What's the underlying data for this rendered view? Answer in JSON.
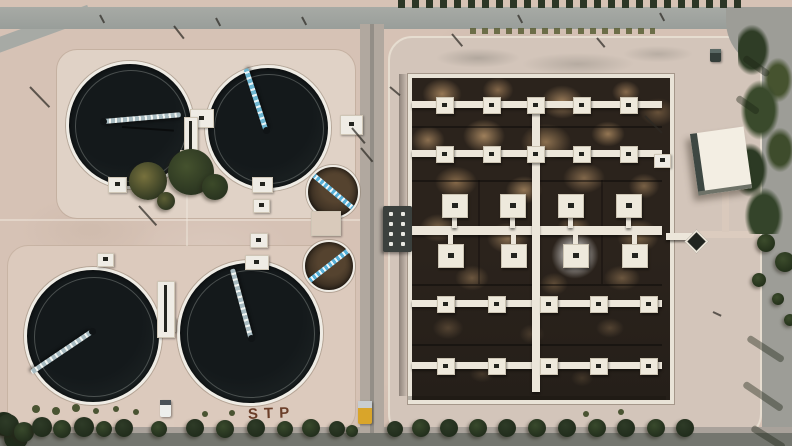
{
  "scene": {
    "title": "Aerial drone view of a sewage treatment plant",
    "ground_text": "STP",
    "description": "Top-down aerial photo: four large dark circular clarifier tanks with scraper bridges and two small circular tanks on sandy ground at left; a large rectangular aeration basin with white walkways and square aerator platforms over mottled brown water at right; roads, trees and a white flat-roof building around the site."
  },
  "palette": {
    "sand": "#d6c2b5",
    "pad_light": "#e0d2c6",
    "apron": "#d3c5ba",
    "road": "#9d9d97",
    "road_dark": "#74766f",
    "tank_water": "#14191b",
    "tank_rim": "#efece5",
    "bridge_blue": "#6fb7d2",
    "bridge_light": "#a9bcc2",
    "basin_dark": "#2b231c",
    "basin_tan": "#a5855f",
    "walkway": "#ece6da",
    "building_roof": "#f3eee3",
    "truck_yellow": "#d9a52a",
    "tree_shades": [
      "#2e3b27",
      "#394a2c",
      "#222e1c"
    ]
  },
  "clarifiers": [
    {
      "id": "clarifier-tank-nw",
      "cx": 127,
      "cy": 122,
      "r": 61,
      "bridge": {
        "x": 103,
        "y": 121,
        "len": 78,
        "angle": -5,
        "style": "light"
      }
    },
    {
      "id": "clarifier-tank-ne",
      "cx": 265,
      "cy": 125,
      "r": 60,
      "bridge": {
        "x": 266,
        "y": 130,
        "len": 65,
        "angle": -108,
        "style": "blue"
      }
    },
    {
      "id": "clarifier-tank-sw",
      "cx": 90,
      "cy": 333,
      "r": 66,
      "bridge": {
        "x": 92,
        "y": 331,
        "len": 73,
        "angle": 146,
        "style": "light"
      }
    },
    {
      "id": "clarifier-tank-se",
      "cx": 247,
      "cy": 330,
      "r": 70,
      "bridge": {
        "x": 251,
        "y": 338,
        "len": 72,
        "angle": -105,
        "style": "light"
      }
    }
  ],
  "small_tanks": [
    {
      "id": "small-tank-upper",
      "cx": 331,
      "cy": 190,
      "r": 25,
      "bridge_angle": 40
    },
    {
      "id": "small-tank-lower",
      "cx": 327,
      "cy": 264,
      "r": 24,
      "bridge_angle": -38
    }
  ],
  "basin": {
    "x": 408,
    "y": 74,
    "w": 258,
    "h": 322,
    "walkway_rows": [
      97,
      146,
      296,
      358
    ],
    "main_walkway_y": 222,
    "vertical_walkway_x": 528,
    "small_rows": [
      {
        "y": 97,
        "cols": [
          440,
          487,
          531,
          577,
          624
        ]
      },
      {
        "y": 146,
        "cols": [
          440,
          487,
          531,
          577,
          624
        ]
      },
      {
        "y": 296,
        "cols": [
          441,
          492,
          544,
          594,
          644
        ]
      },
      {
        "y": 358,
        "cols": [
          441,
          492,
          544,
          594,
          644
        ]
      }
    ],
    "large_upper": {
      "y": 190,
      "cols": [
        450,
        508,
        566,
        624
      ]
    },
    "large_lower": {
      "y": 240,
      "cols": [
        446,
        509,
        571,
        630
      ]
    },
    "dividers_h": [
      122,
      176,
      280,
      340
    ],
    "dividers_v": [
      {
        "x": 474,
        "y1": 176,
        "y2": 280
      },
      {
        "x": 597,
        "y1": 176,
        "y2": 280
      }
    ],
    "foam_halo": {
      "cx": 571,
      "cy": 251
    }
  },
  "structures": {
    "boxes": [
      [
        190,
        109,
        22,
        17,
        "box"
      ],
      [
        108,
        177,
        17,
        14,
        "box"
      ],
      [
        180,
        150,
        16,
        13,
        "box"
      ],
      [
        252,
        177,
        19,
        14,
        "box"
      ],
      [
        253,
        199,
        15,
        12,
        "box"
      ],
      [
        250,
        233,
        16,
        13,
        "box"
      ],
      [
        245,
        255,
        22,
        13,
        "box"
      ],
      [
        97,
        253,
        15,
        12,
        "box"
      ],
      [
        340,
        115,
        21,
        18,
        "box"
      ],
      [
        654,
        154,
        15,
        12,
        "box"
      ],
      [
        160,
        318,
        14,
        12,
        "box"
      ],
      [
        157,
        281,
        16,
        55,
        "channel"
      ],
      [
        184,
        117,
        12,
        50,
        "channel"
      ],
      [
        311,
        211,
        28,
        23,
        "pad"
      ]
    ],
    "junction": {
      "x": 383,
      "y": 206,
      "w": 29,
      "h": 46
    },
    "diamond": {
      "x": 688,
      "y": 233,
      "size": 13
    },
    "diamond_walk": {
      "x": 666,
      "y": 233,
      "w": 26,
      "h": 7
    },
    "building": {
      "x": 694,
      "y": 130,
      "w": 54,
      "h": 62,
      "angle": -8
    }
  },
  "vehicles": [
    {
      "id": "yellow-truck",
      "x": 358,
      "y": 401,
      "w": 14,
      "h": 23,
      "body": "#d9a52a",
      "cab": "#c8cdd0"
    },
    {
      "id": "white-van",
      "x": 160,
      "y": 400,
      "w": 11,
      "h": 17,
      "body": "#edefec",
      "cab": "#4a5258"
    },
    {
      "id": "dark-car",
      "x": 710,
      "y": 49,
      "w": 11,
      "h": 13,
      "body": "#343e3a",
      "cab": "#5c6a66"
    }
  ],
  "landscape": {
    "cluster_trees": [
      [
        148,
        181,
        19,
        "#77713d"
      ],
      [
        191,
        172,
        23,
        "#45522e"
      ],
      [
        215,
        187,
        13,
        "#3c4a29"
      ],
      [
        166,
        201,
        9,
        "#5c5e34"
      ]
    ],
    "bottom_trees": [
      [
        4,
        424,
        12,
        2
      ],
      [
        16,
        438,
        12,
        2
      ],
      [
        8,
        425,
        11,
        0
      ],
      [
        24,
        432,
        10,
        1
      ],
      [
        42,
        427,
        10,
        0
      ],
      [
        62,
        429,
        9,
        1
      ],
      [
        84,
        427,
        10,
        0
      ],
      [
        104,
        429,
        8,
        1
      ],
      [
        124,
        428,
        9,
        0
      ],
      [
        159,
        429,
        8,
        1
      ],
      [
        195,
        428,
        9,
        0
      ],
      [
        225,
        429,
        9,
        1
      ],
      [
        256,
        428,
        9,
        0
      ],
      [
        285,
        429,
        8,
        1
      ],
      [
        311,
        428,
        9,
        1
      ],
      [
        337,
        429,
        8,
        0
      ],
      [
        352,
        431,
        6,
        1
      ],
      [
        395,
        429,
        8,
        0
      ],
      [
        421,
        428,
        9,
        1
      ],
      [
        449,
        428,
        9,
        0
      ],
      [
        478,
        428,
        9,
        1
      ],
      [
        507,
        428,
        9,
        0
      ],
      [
        537,
        428,
        9,
        1
      ],
      [
        567,
        428,
        9,
        0
      ],
      [
        597,
        428,
        9,
        1
      ],
      [
        626,
        428,
        9,
        0
      ],
      [
        656,
        428,
        9,
        1
      ],
      [
        685,
        428,
        9,
        0
      ]
    ],
    "shrubs": [
      [
        36,
        409,
        4
      ],
      [
        56,
        411,
        4
      ],
      [
        76,
        408,
        4
      ],
      [
        96,
        411,
        3
      ],
      [
        116,
        409,
        3
      ],
      [
        136,
        412,
        3
      ],
      [
        205,
        414,
        3
      ],
      [
        232,
        413,
        3
      ],
      [
        586,
        414,
        3
      ],
      [
        621,
        412,
        3
      ]
    ],
    "right_trees": [
      [
        766,
        243,
        9
      ],
      [
        785,
        262,
        10
      ],
      [
        759,
        280,
        7
      ],
      [
        778,
        299,
        6
      ],
      [
        790,
        320,
        6
      ]
    ],
    "poles": [
      [
        30,
        86,
        28,
        46
      ],
      [
        174,
        25,
        16,
        52
      ],
      [
        390,
        86,
        13,
        40
      ],
      [
        352,
        127,
        20,
        50
      ],
      [
        361,
        147,
        18,
        50
      ],
      [
        139,
        205,
        26,
        48
      ],
      [
        645,
        115,
        24,
        45
      ],
      [
        452,
        33,
        16,
        50
      ],
      [
        597,
        37,
        12,
        50
      ],
      [
        216,
        17,
        9,
        62
      ],
      [
        302,
        16,
        9,
        62
      ],
      [
        518,
        14,
        9,
        62
      ],
      [
        660,
        12,
        9,
        62
      ],
      [
        100,
        14,
        9,
        62
      ],
      [
        713,
        311,
        9,
        25
      ]
    ],
    "road_shadows": [
      [
        744,
        54,
        30,
        35
      ],
      [
        737,
        94,
        26,
        35
      ],
      [
        748,
        334,
        42,
        33
      ],
      [
        744,
        380,
        46,
        34
      ],
      [
        752,
        424,
        38,
        32
      ]
    ],
    "water_shadows": [
      [
        122,
        126,
        52,
        4
      ]
    ]
  }
}
